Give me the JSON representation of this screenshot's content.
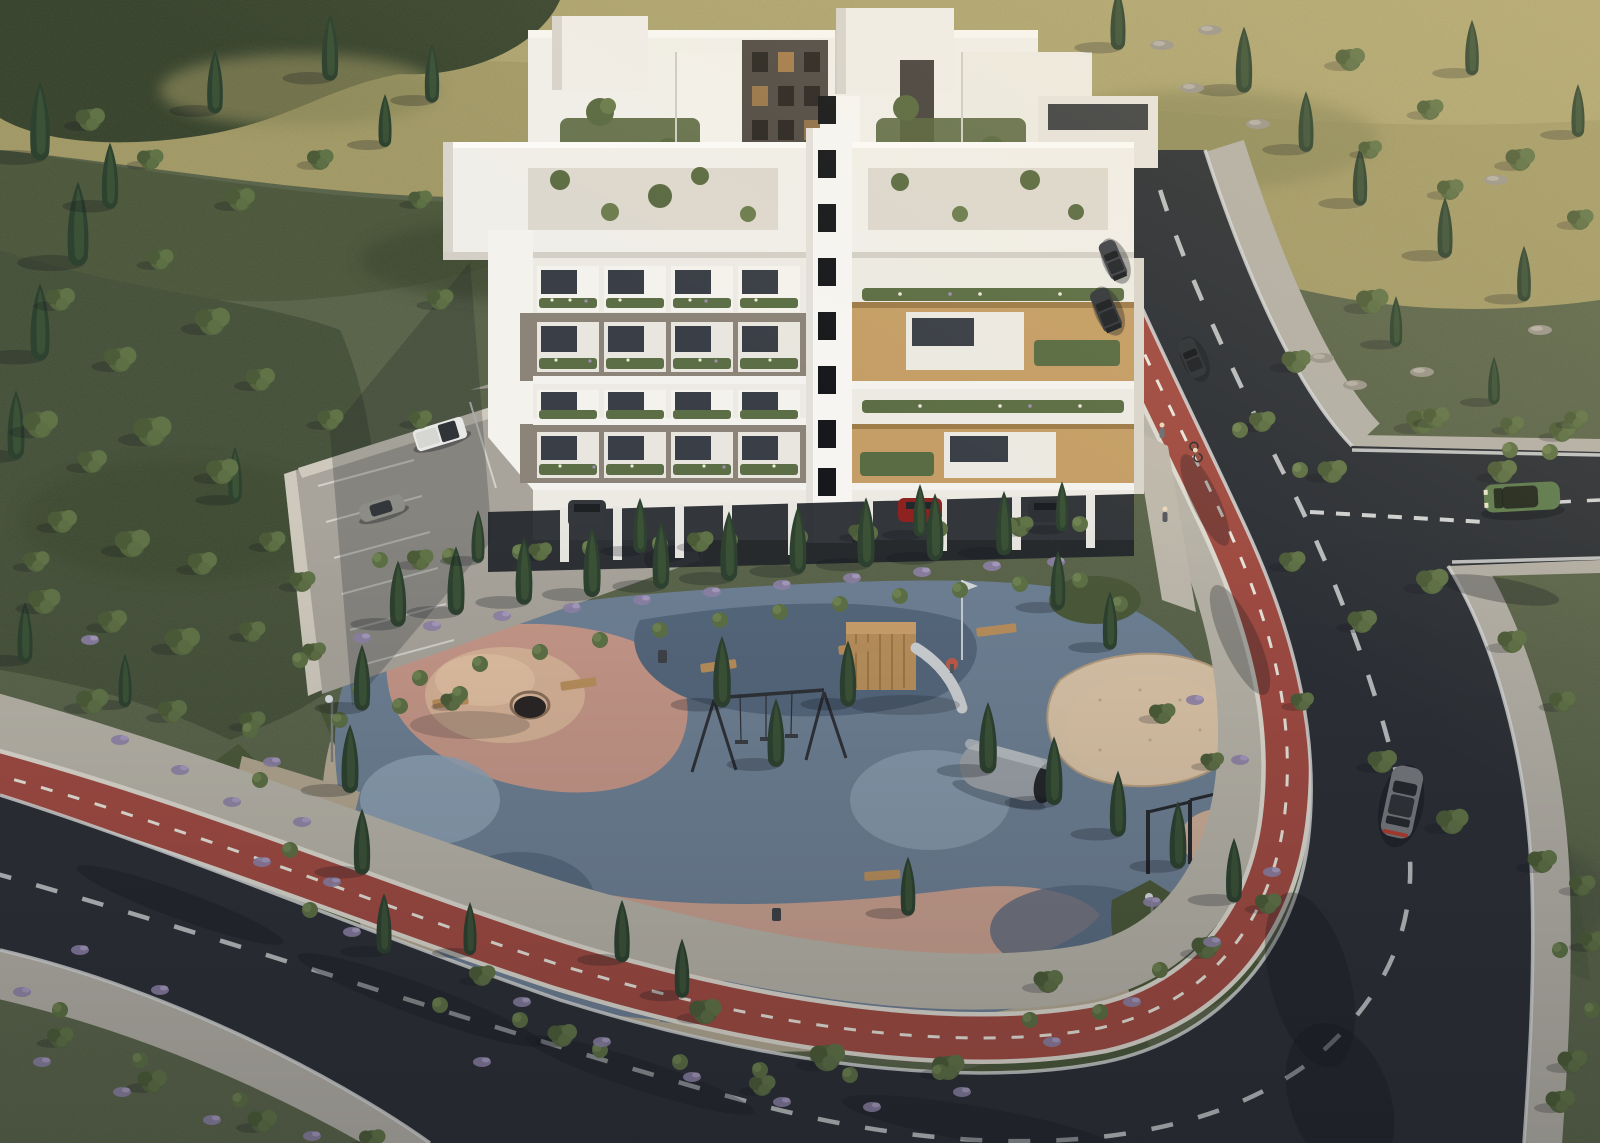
{
  "scene": {
    "description": "Aerial 3D architectural rendering of a modern white apartment complex with rooftop gardens, a landscaped public playground park, red cycle lanes along curving asphalt roads, surface parking and a Mediterranean olive-scrub hillside",
    "style": "photorealistic CGI, late-day sunlight from the north-east with long soft shadows",
    "camera": "high oblique aerial view"
  },
  "colors": {
    "terrain_base": "#5a644a",
    "terrain_sunlit": "#a89e69",
    "terrain_sunlit_light": "#b5aa74",
    "terrain_dark_canopy": "#36422c",
    "terrain_shade": "#4a553a",
    "terrain_grove": "#45513a",
    "asphalt": "#2c3036",
    "road_edge_line": "#d7d8d8",
    "road_dash": "#c9cbcd",
    "bike_lane_red": "#a04b42",
    "bike_lane_white": "#ddd9cf",
    "sidewalk": "#b7b3a8",
    "paver": "#b3afa6",
    "park_gravel": "#b5aa94",
    "hedge_green": "#4b5939",
    "bed_green": "#4a583a",
    "rubber_slate": "#6e8094",
    "rubber_blue_dark": "#55677c",
    "rubber_blue_light": "#8ea2b4",
    "rubber_pink": "#c59788",
    "rubber_pink_deep": "#c9a08f",
    "rubber_tan": "#d6b297",
    "sand": "#dcc6a8",
    "building_white": "#f0eee8",
    "building_shade": "#dbd7cf",
    "building_taupe": "#8d8479",
    "building_wood": "#c49e66",
    "window_dark": "#3a3f47",
    "stairwell_window": "#16181b",
    "planter_green": "#5c6e45",
    "cypress_green": "#2e4230",
    "olive_green": "#56663f",
    "lavender": "#8d82a6",
    "wall_stone": "#cfc9bd",
    "car_white": "#e8e8e6",
    "car_gray": "#8d8d88",
    "car_dark": "#34383d",
    "car_dark2": "#3f434a",
    "car_dark3": "#2e3237",
    "car_red": "#8e2220",
    "car_green": "#5d7a4e",
    "car_silver": "#75787c"
  },
  "objects": {
    "building": {
      "name": "apartment-complex",
      "blocks": 2,
      "floors_visible": 5,
      "features": [
        "rooftop gardens with olive trees",
        "balconies with flower planters",
        "timber-clad balcony frames on east wing",
        "taupe concrete balcony frames on west wing",
        "central stairwell tower with stacked dark windows",
        "ground floor on pilotis with covered parking"
      ]
    },
    "park": {
      "name": "playground-park",
      "surface": "organic multicolour rubber safety surface in slate blue, dusty pink and tan",
      "equipment": [
        "climbing mound with tunnel",
        "timber climbing tower with slide",
        "swing set",
        "sand pit",
        "rope climbing frame with fireman pole",
        "calisthenics pull-up bars",
        "metal play barrel",
        "timber benches",
        "street lamps",
        "litter bins"
      ],
      "planting": [
        "rows of Italian cypress",
        "olive trees",
        "lavender and shrub beds"
      ]
    },
    "roads": {
      "main_road": "dark asphalt with dashed white centreline and solid white edge lines",
      "cycle_lane": "red two-way cycle lane with dashed white centreline following the road around the park",
      "sidewalks": "light stone paver walkways on both sides",
      "junction": "T-junction with give-way dashes and a side road exiting east"
    },
    "vehicles": [
      {
        "name": "white-pickup-truck",
        "location": "parking lot"
      },
      {
        "name": "gray-hatchback",
        "location": "parking lot"
      },
      {
        "name": "dark-car-north-lot",
        "location": "upper parking row"
      },
      {
        "name": "dark-suv-under-building",
        "location": "under building"
      },
      {
        "name": "red-car-under-building",
        "location": "under building"
      },
      {
        "name": "dark-car-under-building",
        "location": "under building"
      },
      {
        "name": "dark-sedan",
        "location": "upper road northbound"
      },
      {
        "name": "dark-suv",
        "location": "upper road northbound"
      },
      {
        "name": "dark-car",
        "location": "upper road"
      },
      {
        "name": "green-suv",
        "location": "side road at junction"
      },
      {
        "name": "gray-sedan",
        "location": "lower curve driving south"
      }
    ],
    "people": [
      {
        "name": "pedestrian",
        "location": "walkway beside building"
      },
      {
        "name": "cyclist",
        "location": "red cycle lane"
      },
      {
        "name": "pedestrian",
        "location": "walkway beside building"
      }
    ]
  },
  "vegetation": {
    "cypresses_hillside": [
      [
        40,
        150,
        1.5
      ],
      [
        78,
        255,
        1.6
      ],
      [
        40,
        350,
        1.45
      ],
      [
        16,
        450,
        1.3
      ],
      [
        110,
        200,
        1.25
      ],
      [
        215,
        105,
        1.2
      ],
      [
        330,
        72,
        1.25
      ],
      [
        235,
        495,
        1.05
      ],
      [
        25,
        655,
        1.15
      ],
      [
        125,
        700,
        1.0
      ],
      [
        1118,
        42,
        1.15
      ],
      [
        1244,
        84,
        1.25
      ],
      [
        1306,
        144,
        1.15
      ],
      [
        1360,
        198,
        1.1
      ],
      [
        1445,
        250,
        1.15
      ],
      [
        1524,
        294,
        1.05
      ],
      [
        1578,
        130,
        1.0
      ],
      [
        1472,
        68,
        1.05
      ],
      [
        1396,
        340,
        0.95
      ],
      [
        1494,
        398,
        0.9
      ],
      [
        432,
        95,
        1.1
      ],
      [
        385,
        140,
        1.0
      ]
    ],
    "cypresses_park": [
      [
        398,
        618,
        1.25
      ],
      [
        456,
        606,
        1.3
      ],
      [
        524,
        596,
        1.28
      ],
      [
        592,
        588,
        1.32
      ],
      [
        661,
        580,
        1.28
      ],
      [
        729,
        572,
        1.32
      ],
      [
        798,
        565,
        1.28
      ],
      [
        866,
        558,
        1.32
      ],
      [
        935,
        552,
        1.28
      ],
      [
        1004,
        547,
        1.22
      ],
      [
        362,
        702,
        1.25
      ],
      [
        350,
        784,
        1.3
      ],
      [
        362,
        866,
        1.25
      ],
      [
        384,
        946,
        1.15
      ],
      [
        722,
        698,
        1.35
      ],
      [
        776,
        758,
        1.3
      ],
      [
        848,
        698,
        1.25
      ],
      [
        988,
        764,
        1.35
      ],
      [
        1054,
        796,
        1.3
      ],
      [
        1118,
        828,
        1.25
      ],
      [
        1178,
        860,
        1.28
      ],
      [
        1234,
        894,
        1.22
      ],
      [
        622,
        954,
        1.18
      ],
      [
        682,
        990,
        1.12
      ],
      [
        908,
        908,
        1.12
      ],
      [
        1058,
        602,
        1.12
      ],
      [
        1110,
        642,
        1.1
      ],
      [
        470,
        948,
        1.0
      ],
      [
        478,
        556,
        1.0
      ],
      [
        640,
        546,
        1.05
      ],
      [
        920,
        530,
        1.0
      ],
      [
        1062,
        525,
        0.95
      ]
    ],
    "olives": [
      [
        40,
        425,
        1.2
      ],
      [
        92,
        462,
        1.0
      ],
      [
        152,
        432,
        1.3
      ],
      [
        222,
        472,
        1.1
      ],
      [
        62,
        522,
        1.0
      ],
      [
        132,
        544,
        1.2
      ],
      [
        202,
        564,
        1.0
      ],
      [
        272,
        542,
        0.9
      ],
      [
        44,
        602,
        1.1
      ],
      [
        112,
        622,
        1.0
      ],
      [
        182,
        642,
        1.2
      ],
      [
        252,
        632,
        0.9
      ],
      [
        92,
        702,
        1.1
      ],
      [
        172,
        712,
        1.0
      ],
      [
        252,
        722,
        0.9
      ],
      [
        36,
        562,
        0.9
      ],
      [
        302,
        582,
        0.9
      ],
      [
        314,
        652,
        0.8
      ],
      [
        1296,
        362,
        1.0
      ],
      [
        1372,
        302,
        1.1
      ],
      [
        1262,
        422,
        0.9
      ],
      [
        1332,
        472,
        1.0
      ],
      [
        1422,
        422,
        1.1
      ],
      [
        1502,
        472,
        1.0
      ],
      [
        1562,
        432,
        0.9
      ],
      [
        1292,
        562,
        0.9
      ],
      [
        1362,
        622,
        1.0
      ],
      [
        1432,
        582,
        1.1
      ],
      [
        1512,
        642,
        1.0
      ],
      [
        1562,
        702,
        0.9
      ],
      [
        1302,
        702,
        0.8
      ],
      [
        1382,
        762,
        1.0
      ],
      [
        1452,
        822,
        1.1
      ],
      [
        1542,
        862,
        1.0
      ],
      [
        1592,
        942,
        0.9
      ],
      [
        1572,
        1062,
        1.0
      ],
      [
        705,
        1012,
        1.1
      ],
      [
        827,
        1058,
        1.2
      ],
      [
        948,
        1068,
        1.1
      ],
      [
        1048,
        982,
        1.0
      ],
      [
        762,
        1086,
        0.9
      ],
      [
        562,
        1036,
        1.0
      ],
      [
        482,
        976,
        0.9
      ],
      [
        1206,
        948,
        1.0
      ],
      [
        1268,
        904,
        0.9
      ],
      [
        1162,
        714,
        0.9
      ],
      [
        1212,
        762,
        0.8
      ],
      [
        1436,
        418,
        0.9
      ],
      [
        1512,
        426,
        0.8
      ],
      [
        1576,
        420,
        0.8
      ],
      [
        1582,
        886,
        0.9
      ],
      [
        1560,
        1102,
        1.0
      ],
      [
        60,
        1038,
        0.9
      ],
      [
        152,
        1082,
        1.0
      ],
      [
        262,
        1122,
        1.0
      ],
      [
        372,
        1140,
        0.9
      ],
      [
        452,
        702,
        0.8
      ],
      [
        212,
        322,
        1.2
      ],
      [
        120,
        360,
        1.1
      ],
      [
        60,
        300,
        1.0
      ],
      [
        160,
        260,
        0.9
      ],
      [
        260,
        380,
        1.0
      ],
      [
        330,
        420,
        0.9
      ],
      [
        240,
        200,
        1.0
      ],
      [
        150,
        160,
        0.9
      ],
      [
        90,
        120,
        1.0
      ],
      [
        320,
        160,
        0.9
      ],
      [
        420,
        200,
        0.8
      ],
      [
        440,
        300,
        0.9
      ],
      [
        420,
        420,
        0.8
      ],
      [
        1350,
        60,
        1.0
      ],
      [
        1430,
        110,
        0.9
      ],
      [
        1520,
        160,
        1.0
      ],
      [
        1580,
        220,
        0.9
      ],
      [
        1370,
        150,
        0.8
      ],
      [
        1450,
        190,
        0.9
      ],
      [
        420,
        560,
        0.9
      ],
      [
        540,
        552,
        0.8
      ],
      [
        700,
        542,
        0.9
      ],
      [
        860,
        533,
        0.8
      ],
      [
        1020,
        527,
        0.9
      ]
    ],
    "shrubs": [
      [
        360,
        690
      ],
      [
        420,
        678
      ],
      [
        480,
        664
      ],
      [
        540,
        652
      ],
      [
        600,
        640
      ],
      [
        660,
        630
      ],
      [
        720,
        620
      ],
      [
        780,
        612
      ],
      [
        840,
        604
      ],
      [
        900,
        596
      ],
      [
        960,
        590
      ],
      [
        1020,
        584
      ],
      [
        1080,
        580
      ],
      [
        340,
        720
      ],
      [
        400,
        706
      ],
      [
        460,
        694
      ],
      [
        1120,
        604
      ],
      [
        300,
        660
      ],
      [
        440,
        1005
      ],
      [
        520,
        1020
      ],
      [
        600,
        1050
      ],
      [
        680,
        1062
      ],
      [
        760,
        1070
      ],
      [
        850,
        1075
      ],
      [
        940,
        1072
      ],
      [
        1030,
        1020
      ],
      [
        1100,
        1012
      ],
      [
        1160,
        970
      ],
      [
        260,
        780
      ],
      [
        290,
        850
      ],
      [
        310,
        910
      ],
      [
        250,
        730
      ],
      [
        1240,
        430
      ],
      [
        1300,
        470
      ],
      [
        1510,
        450
      ],
      [
        1550,
        452
      ],
      [
        140,
        1060
      ],
      [
        240,
        1100
      ],
      [
        60,
        1010
      ],
      [
        1592,
        1010
      ],
      [
        1560,
        950
      ],
      [
        380,
        560
      ],
      [
        450,
        556
      ],
      [
        520,
        552
      ],
      [
        590,
        548
      ],
      [
        660,
        544
      ],
      [
        730,
        540
      ],
      [
        800,
        537
      ],
      [
        870,
        533
      ],
      [
        940,
        529
      ],
      [
        1010,
        526
      ],
      [
        1080,
        524
      ]
    ],
    "lavender": [
      [
        42,
        1062
      ],
      [
        122,
        1092
      ],
      [
        212,
        1120
      ],
      [
        312,
        1136
      ],
      [
        22,
        992
      ],
      [
        272,
        762
      ],
      [
        302,
        822
      ],
      [
        332,
        882
      ],
      [
        262,
        862
      ],
      [
        352,
        932
      ],
      [
        232,
        802
      ],
      [
        522,
        1002
      ],
      [
        602,
        1042
      ],
      [
        692,
        1077
      ],
      [
        782,
        1102
      ],
      [
        872,
        1107
      ],
      [
        962,
        1092
      ],
      [
        1052,
        1042
      ],
      [
        1132,
        1002
      ],
      [
        482,
        1062
      ],
      [
        362,
        638
      ],
      [
        432,
        626
      ],
      [
        502,
        616
      ],
      [
        572,
        608
      ],
      [
        642,
        600
      ],
      [
        712,
        592
      ],
      [
        782,
        585
      ],
      [
        852,
        578
      ],
      [
        922,
        572
      ],
      [
        992,
        566
      ],
      [
        1056,
        562
      ],
      [
        1152,
        902
      ],
      [
        1212,
        942
      ],
      [
        1272,
        872
      ],
      [
        120,
        740
      ],
      [
        180,
        770
      ],
      [
        90,
        640
      ],
      [
        1195,
        700
      ],
      [
        1240,
        760
      ],
      [
        160,
        990
      ],
      [
        80,
        950
      ]
    ],
    "rocks": [
      [
        1192,
        88
      ],
      [
        1258,
        124
      ],
      [
        1322,
        358
      ],
      [
        1355,
        385
      ],
      [
        1422,
        372
      ],
      [
        1162,
        45
      ],
      [
        1540,
        330
      ],
      [
        1496,
        180
      ],
      [
        1210,
        30
      ]
    ]
  }
}
